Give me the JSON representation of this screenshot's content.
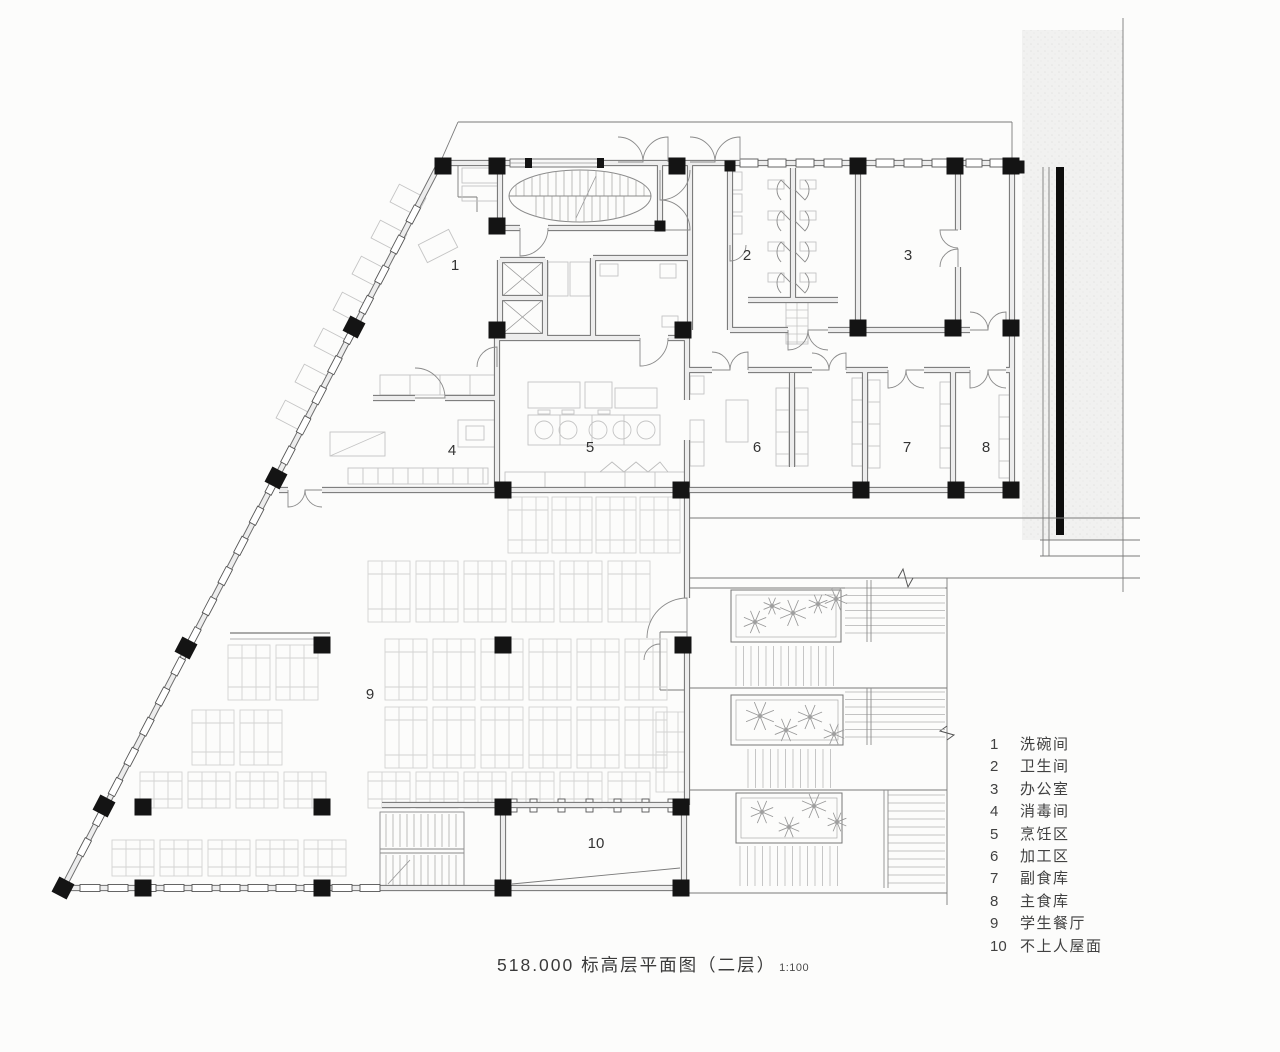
{
  "drawing": {
    "title": "518.000 标高层平面图（二层）",
    "scale": "1:100"
  },
  "legend": {
    "items": [
      {
        "num": "1",
        "label": "洗碗间"
      },
      {
        "num": "2",
        "label": "卫生间"
      },
      {
        "num": "3",
        "label": "办公室"
      },
      {
        "num": "4",
        "label": "消毒间"
      },
      {
        "num": "5",
        "label": "烹饪区"
      },
      {
        "num": "6",
        "label": "加工区"
      },
      {
        "num": "7",
        "label": "副食库"
      },
      {
        "num": "8",
        "label": "主食库"
      },
      {
        "num": "9",
        "label": "学生餐厅"
      },
      {
        "num": "10",
        "label": "不上人屋面"
      }
    ]
  },
  "rooms": [
    {
      "number": "1",
      "name": "洗碗间"
    },
    {
      "number": "2",
      "name": "卫生间"
    },
    {
      "number": "3",
      "name": "办公室"
    },
    {
      "number": "4",
      "name": "消毒间"
    },
    {
      "number": "5",
      "name": "烹饪区"
    },
    {
      "number": "6",
      "name": "加工区"
    },
    {
      "number": "7",
      "name": "副食库"
    },
    {
      "number": "8",
      "name": "主食库"
    },
    {
      "number": "9",
      "name": "学生餐厅"
    },
    {
      "number": "10",
      "name": "不上人屋面"
    }
  ]
}
